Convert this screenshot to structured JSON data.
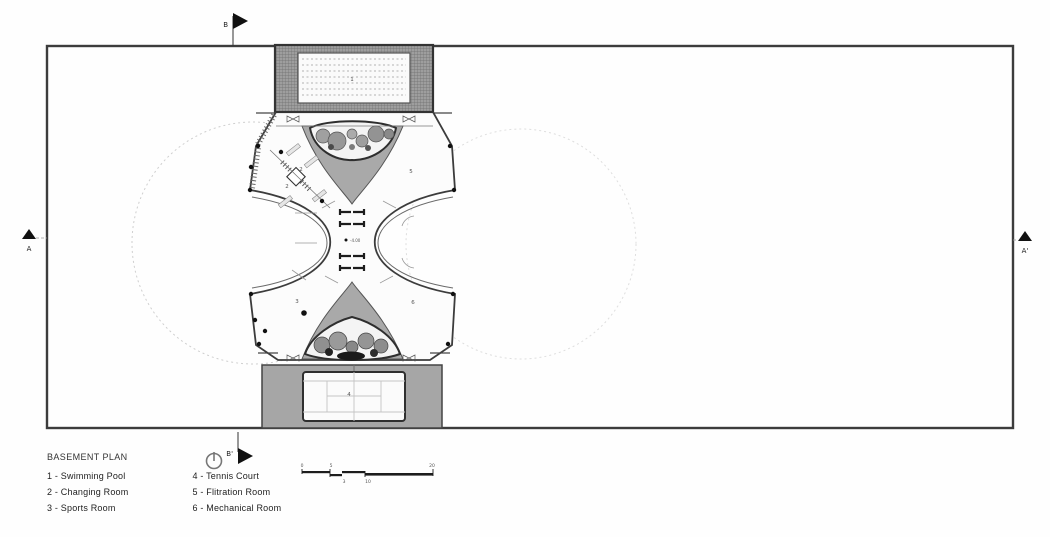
{
  "plan": {
    "labels": {
      "pool": "1",
      "changing_a": "2",
      "changing_b": "2",
      "sports": "3",
      "tennis": "4",
      "filtration": "5",
      "mechanical": "6",
      "level": "-4.00"
    },
    "markers": {
      "a": "A",
      "a_prime": "A'",
      "b": "B",
      "b_prime": "B'"
    }
  },
  "legend": {
    "title": "BASEMENT PLAN",
    "col1": [
      "1 - Swimming Pool",
      "2 - Changing Room",
      "3 - Sports Room"
    ],
    "col2": [
      "4 - Tennis Court",
      "5 - Flitration Room",
      "6 - Mechanical Room"
    ]
  },
  "scale_bar": {
    "t0": "0",
    "t5": "5",
    "t20": "20",
    "b3": "3",
    "b10": "10"
  },
  "colors": {
    "line": "#3c3c3c",
    "gray_fill": "#a9a9a9",
    "hatch_fill": "#9e9e9e",
    "faint_dash": "#cfcfcf"
  }
}
